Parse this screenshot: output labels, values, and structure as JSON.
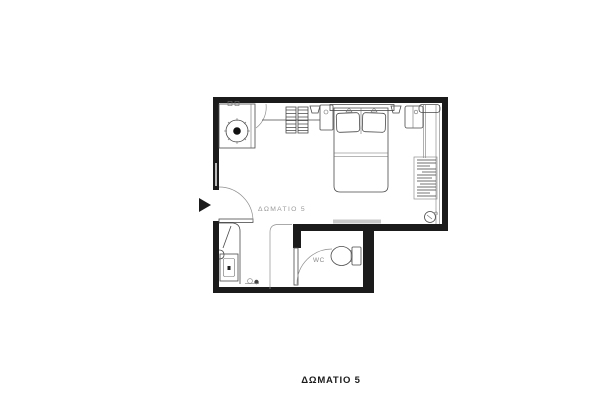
{
  "plan": {
    "room_label": "ΔΩΜΑΤΙΟ 5",
    "wc_label": "WC",
    "caption": "ΔΩΜΑΤΙΟ 5"
  },
  "colors": {
    "background": "#ffffff",
    "wall": "#1b1b1b",
    "furniture_line": "#4a4a4a",
    "light_line": "#8f8f8f",
    "label_gray": "#9b9b9b",
    "caption_black": "#1b1b1b"
  },
  "icons": {
    "entrance_marker": "right-pointing-triangle"
  }
}
